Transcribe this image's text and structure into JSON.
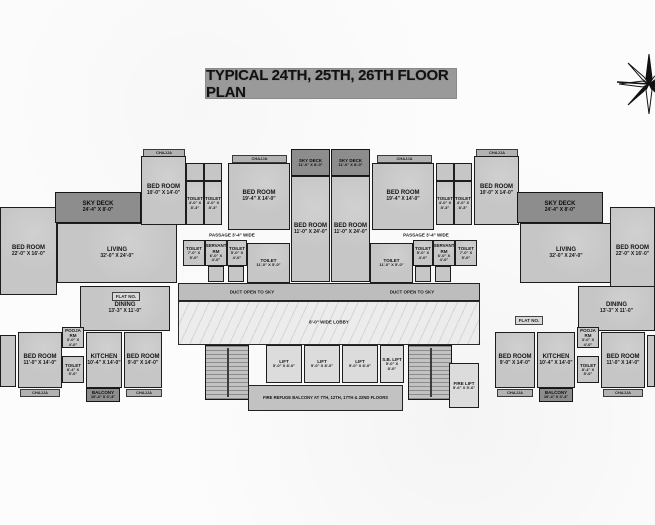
{
  "title": "TYPICAL 24TH, 25TH, 26TH FLOOR PLAN",
  "colors": {
    "room_fill": "#c6c6c6",
    "deck_fill": "#8d8d8d",
    "lobby_fill": "#ececec",
    "wall": "#1d1d1d",
    "title_bg": "#9a9a9a",
    "background": "#fcfcfc"
  },
  "compass": "north-compass-rose",
  "plan": {
    "rooms": [
      {
        "name": "chajja-top-left",
        "kind": "chajja",
        "label": "CHAJJA",
        "x": 143,
        "y": 149,
        "w": 42,
        "h": 8
      },
      {
        "name": "chajja-top-left2",
        "kind": "chajja",
        "label": "CHAJJA",
        "x": 232,
        "y": 155,
        "w": 55,
        "h": 8
      },
      {
        "name": "chajja-top-right2",
        "kind": "chajja",
        "label": "CHAJJA",
        "x": 377,
        "y": 155,
        "w": 55,
        "h": 8
      },
      {
        "name": "chajja-top-right",
        "kind": "chajja",
        "label": "CHAJJA",
        "x": 476,
        "y": 149,
        "w": 42,
        "h": 8
      },
      {
        "name": "bedroom-left-edge",
        "kind": "room",
        "label": "BED ROOM",
        "dims": "22'-0\" X 16'-0\"",
        "x": 0,
        "y": 207,
        "w": 57,
        "h": 88
      },
      {
        "name": "sky-deck-left",
        "kind": "deck",
        "label": "SKY DECK",
        "dims": "24'-4\" X 8'-0\"",
        "x": 55,
        "y": 192,
        "w": 86,
        "h": 31
      },
      {
        "name": "living-left",
        "kind": "room",
        "label": "LIVING",
        "dims": "32'-0\" X 24'-0\"",
        "x": 57,
        "y": 223,
        "w": 120,
        "h": 60
      },
      {
        "name": "bedroom-10-left",
        "kind": "room",
        "label": "BED ROOM",
        "dims": "10'-0\" X 14'-0\"",
        "x": 141,
        "y": 156,
        "w": 45,
        "h": 69
      },
      {
        "name": "closet-left-a",
        "kind": "plain room small",
        "x": 186,
        "y": 163,
        "w": 18,
        "h": 18
      },
      {
        "name": "closet-left-b",
        "kind": "plain room small",
        "x": 204,
        "y": 163,
        "w": 18,
        "h": 18
      },
      {
        "name": "toilet-left-a",
        "kind": "room small",
        "label": "TOILET",
        "dims": "4'-0\" X 8'-3\"",
        "x": 186,
        "y": 181,
        "w": 18,
        "h": 44
      },
      {
        "name": "toilet-left-b",
        "kind": "room small",
        "label": "TOILET",
        "dims": "4'-0\" X 8'-3\"",
        "x": 204,
        "y": 181,
        "w": 18,
        "h": 44
      },
      {
        "name": "bedroom-19-left",
        "kind": "room",
        "label": "BED ROOM",
        "dims": "19'-4\" X 14'-0\"",
        "x": 228,
        "y": 163,
        "w": 62,
        "h": 67
      },
      {
        "name": "sky-deck-center-1",
        "kind": "deck small",
        "label": "SKY DECK",
        "dims": "11'-0\" X 8'-0\"",
        "x": 291,
        "y": 149,
        "w": 39,
        "h": 27
      },
      {
        "name": "sky-deck-center-2",
        "kind": "deck small",
        "label": "SKY DECK",
        "dims": "11'-0\" X 8'-0\"",
        "x": 331,
        "y": 149,
        "w": 39,
        "h": 27
      },
      {
        "name": "bedroom-24-center-1",
        "kind": "room",
        "label": "BED ROOM",
        "dims": "11'-0\" X 24'-0\"",
        "x": 291,
        "y": 176,
        "w": 39,
        "h": 106
      },
      {
        "name": "bedroom-24-center-2",
        "kind": "room",
        "label": "BED ROOM",
        "dims": "11'-0\" X 24'-0\"",
        "x": 331,
        "y": 176,
        "w": 39,
        "h": 106
      },
      {
        "name": "bedroom-19-right",
        "kind": "room",
        "label": "BED ROOM",
        "dims": "19'-4\" X 14'-0\"",
        "x": 372,
        "y": 163,
        "w": 62,
        "h": 67
      },
      {
        "name": "closet-right-a",
        "kind": "plain room small",
        "x": 436,
        "y": 163,
        "w": 18,
        "h": 18
      },
      {
        "name": "closet-right-b",
        "kind": "plain room small",
        "x": 454,
        "y": 163,
        "w": 18,
        "h": 18
      },
      {
        "name": "toilet-right-a",
        "kind": "room small",
        "label": "TOILET",
        "dims": "4'-0\" X 8'-3\"",
        "x": 436,
        "y": 181,
        "w": 18,
        "h": 44
      },
      {
        "name": "toilet-right-b",
        "kind": "room small",
        "label": "TOILET",
        "dims": "4'-0\" X 8'-3\"",
        "x": 454,
        "y": 181,
        "w": 18,
        "h": 44
      },
      {
        "name": "bedroom-10-right",
        "kind": "room",
        "label": "BED ROOM",
        "dims": "10'-0\" X 14'-0\"",
        "x": 474,
        "y": 156,
        "w": 45,
        "h": 69
      },
      {
        "name": "sky-deck-right",
        "kind": "deck",
        "label": "SKY DECK",
        "dims": "24'-4\" X 8'-0\"",
        "x": 517,
        "y": 192,
        "w": 86,
        "h": 31
      },
      {
        "name": "living-right",
        "kind": "room",
        "label": "LIVING",
        "dims": "32'-0\" X 24'-0\"",
        "x": 520,
        "y": 223,
        "w": 92,
        "h": 60
      },
      {
        "name": "bedroom-right-edge",
        "kind": "room",
        "label": "BED ROOM",
        "dims": "22'-0\" X 16'-0\"",
        "x": 610,
        "y": 207,
        "w": 45,
        "h": 88
      },
      {
        "name": "toilet-mid-left-1",
        "kind": "room small",
        "label": "TOILET",
        "dims": "7'-0\" X 5'-0\"",
        "x": 183,
        "y": 240,
        "w": 22,
        "h": 26
      },
      {
        "name": "servant-rm-left",
        "kind": "room small",
        "label": "SERVANT RM",
        "dims": "6'-0\" X 4'-0\"",
        "x": 205,
        "y": 240,
        "w": 22,
        "h": 26
      },
      {
        "name": "toilet-mid-left-2",
        "kind": "room small",
        "label": "TOILET",
        "dims": "5'-0\" X 4'-0\"",
        "x": 227,
        "y": 240,
        "w": 20,
        "h": 26
      },
      {
        "name": "toilet-11-left",
        "kind": "room small",
        "label": "TOILET",
        "dims": "11'-0\" X 5'-0\"",
        "x": 247,
        "y": 243,
        "w": 43,
        "h": 40
      },
      {
        "name": "store-left-a",
        "kind": "plain room small",
        "x": 208,
        "y": 266,
        "w": 16,
        "h": 16
      },
      {
        "name": "store-left-b",
        "kind": "plain room small",
        "x": 228,
        "y": 266,
        "w": 16,
        "h": 16
      },
      {
        "name": "toilet-11-right",
        "kind": "room small",
        "label": "TOILET",
        "dims": "11'-0\" X 5'-0\"",
        "x": 370,
        "y": 243,
        "w": 43,
        "h": 40
      },
      {
        "name": "toilet-mid-right-1",
        "kind": "room small",
        "label": "TOILET",
        "dims": "5'-0\" X 4'-0\"",
        "x": 413,
        "y": 240,
        "w": 20,
        "h": 26
      },
      {
        "name": "servant-rm-right",
        "kind": "room small",
        "label": "SERVANT RM",
        "dims": "6'-0\" X 4'-0\"",
        "x": 433,
        "y": 240,
        "w": 22,
        "h": 26
      },
      {
        "name": "toilet-mid-right-2",
        "kind": "room small",
        "label": "TOILET",
        "dims": "7'-0\" X 5'-0\"",
        "x": 455,
        "y": 240,
        "w": 22,
        "h": 26
      },
      {
        "name": "store-right-a",
        "kind": "plain room small",
        "x": 415,
        "y": 266,
        "w": 16,
        "h": 16
      },
      {
        "name": "store-right-b",
        "kind": "plain room small",
        "x": 435,
        "y": 266,
        "w": 16,
        "h": 16
      },
      {
        "name": "duct-open-to-sky",
        "kind": "duct room",
        "x": 178,
        "y": 283,
        "w": 302,
        "h": 18
      },
      {
        "name": "lobby",
        "kind": "lobby room",
        "x": 178,
        "y": 301,
        "w": 302,
        "h": 44
      },
      {
        "name": "staircase-left",
        "kind": "stair room",
        "x": 205,
        "y": 345,
        "w": 44,
        "h": 55
      },
      {
        "name": "lift-1",
        "kind": "lift room",
        "label": "LIFT",
        "dims": "5'-0\" X 8'-0\"",
        "x": 266,
        "y": 345,
        "w": 36,
        "h": 38
      },
      {
        "name": "lift-2",
        "kind": "lift room",
        "label": "LIFT",
        "dims": "5'-0\" X 8'-0\"",
        "x": 304,
        "y": 345,
        "w": 36,
        "h": 38
      },
      {
        "name": "lift-3",
        "kind": "lift room",
        "label": "LIFT",
        "dims": "5'-0\" X 8'-0\"",
        "x": 342,
        "y": 345,
        "w": 36,
        "h": 38
      },
      {
        "name": "sb-lift",
        "kind": "lift room",
        "label": "S.B. LIFT",
        "dims": "5'-0\" X 8'-0\"",
        "x": 380,
        "y": 345,
        "w": 24,
        "h": 38
      },
      {
        "name": "staircase-right",
        "kind": "stair room",
        "x": 408,
        "y": 345,
        "w": 44,
        "h": 55
      },
      {
        "name": "fire-lift",
        "kind": "lift room",
        "label": "FIRE LIFT",
        "dims": "5'-6\" X 5'-6\"",
        "x": 449,
        "y": 363,
        "w": 30,
        "h": 45
      },
      {
        "name": "fire-refuge-balcony",
        "kind": "note room",
        "label": "FIRE REFUGE BALCONY AT 7TH, 12TH, 17TH & 22ND FLOORS",
        "x": 248,
        "y": 385,
        "w": 155,
        "h": 26
      },
      {
        "name": "dining-left",
        "kind": "room",
        "label": "DINING",
        "dims": "13'-3\" X 11'-0\"",
        "x": 80,
        "y": 286,
        "w": 90,
        "h": 45
      },
      {
        "name": "bedroom-bottom-left-partial",
        "kind": "plain room",
        "x": 0,
        "y": 335,
        "w": 16,
        "h": 52
      },
      {
        "name": "bedroom-11-bottom-left",
        "kind": "room",
        "label": "BED ROOM",
        "dims": "11'-0\" X 14'-0\"",
        "x": 18,
        "y": 332,
        "w": 44,
        "h": 56
      },
      {
        "name": "pooja-rm-left",
        "kind": "room small",
        "label": "POOJA RM",
        "dims": "3'-0\" X 4'-0\"",
        "x": 62,
        "y": 327,
        "w": 22,
        "h": 21
      },
      {
        "name": "toilet-bottom-left",
        "kind": "room small",
        "label": "TOILET",
        "dims": "8'-4\" X 5'-0\"",
        "x": 62,
        "y": 356,
        "w": 22,
        "h": 27
      },
      {
        "name": "kitchen-left",
        "kind": "room",
        "label": "KITCHEN",
        "dims": "10'-4\" X 14'-0\"",
        "x": 86,
        "y": 332,
        "w": 36,
        "h": 56
      },
      {
        "name": "bedroom-9-bottom-left",
        "kind": "room",
        "label": "BED ROOM",
        "dims": "9'-0\" X 14'-0\"",
        "x": 124,
        "y": 332,
        "w": 38,
        "h": 56
      },
      {
        "name": "balcony-left",
        "kind": "deck small",
        "label": "BALCONY",
        "dims": "10'-4\" X 3'-4\"",
        "x": 86,
        "y": 388,
        "w": 34,
        "h": 14
      },
      {
        "name": "chajja-bottom-left-1",
        "kind": "chajja",
        "label": "CHAJJA",
        "x": 20,
        "y": 389,
        "w": 40,
        "h": 8
      },
      {
        "name": "chajja-bottom-left-2",
        "kind": "chajja",
        "label": "CHAJJA",
        "x": 126,
        "y": 389,
        "w": 36,
        "h": 8
      },
      {
        "name": "dining-right",
        "kind": "room",
        "label": "DINING",
        "dims": "13'-3\" X 11'-0\"",
        "x": 578,
        "y": 286,
        "w": 77,
        "h": 45
      },
      {
        "name": "bedroom-9-bottom-right",
        "kind": "room",
        "label": "BED ROOM",
        "dims": "9'-0\" X 14'-0\"",
        "x": 495,
        "y": 332,
        "w": 40,
        "h": 56
      },
      {
        "name": "kitchen-right",
        "kind": "room",
        "label": "KITCHEN",
        "dims": "10'-4\" X 14'-0\"",
        "x": 537,
        "y": 332,
        "w": 38,
        "h": 56
      },
      {
        "name": "pooja-rm-right",
        "kind": "room small",
        "label": "POOJA RM",
        "dims": "3'-0\" X 4'-0\"",
        "x": 577,
        "y": 327,
        "w": 22,
        "h": 21
      },
      {
        "name": "toilet-bottom-right",
        "kind": "room small",
        "label": "TOILET",
        "dims": "8'-4\" X 5'-0\"",
        "x": 577,
        "y": 356,
        "w": 22,
        "h": 27
      },
      {
        "name": "bedroom-11-bottom-right",
        "kind": "room",
        "label": "BED ROOM",
        "dims": "11'-0\" X 14'-0\"",
        "x": 601,
        "y": 332,
        "w": 44,
        "h": 56
      },
      {
        "name": "bedroom-bottom-right-partial",
        "kind": "plain room",
        "x": 647,
        "y": 335,
        "w": 8,
        "h": 52
      },
      {
        "name": "balcony-right",
        "kind": "deck small",
        "label": "BALCONY",
        "dims": "10'-4\" X 3'-4\"",
        "x": 539,
        "y": 388,
        "w": 34,
        "h": 14
      },
      {
        "name": "chajja-bottom-right-1",
        "kind": "chajja",
        "label": "CHAJJA",
        "x": 497,
        "y": 389,
        "w": 36,
        "h": 8
      },
      {
        "name": "chajja-bottom-right-2",
        "kind": "chajja",
        "label": "CHAJJA",
        "x": 603,
        "y": 389,
        "w": 40,
        "h": 8
      }
    ],
    "texts": [
      {
        "name": "passage-left-label",
        "text": "PASSAGE 3'-4\" WIDE",
        "x": 232,
        "y": 235
      },
      {
        "name": "passage-right-label",
        "text": "PASSAGE 3'-4\" WIDE",
        "x": 426,
        "y": 235
      },
      {
        "name": "duct-left-label",
        "text": "DUCT OPEN TO SKY",
        "x": 252,
        "y": 292
      },
      {
        "name": "duct-right-label",
        "text": "DUCT OPEN TO SKY",
        "x": 412,
        "y": 292
      },
      {
        "name": "lobby-label",
        "text": "8'-0\" WIDE LOBBY",
        "x": 329,
        "y": 322
      }
    ],
    "tags": [
      {
        "name": "flat-no-left",
        "text": "FLAT NO.",
        "x": 112,
        "y": 292,
        "w": 28,
        "h": 9
      },
      {
        "name": "flat-no-right",
        "text": "FLAT NO.",
        "x": 515,
        "y": 316,
        "w": 28,
        "h": 9
      }
    ]
  }
}
